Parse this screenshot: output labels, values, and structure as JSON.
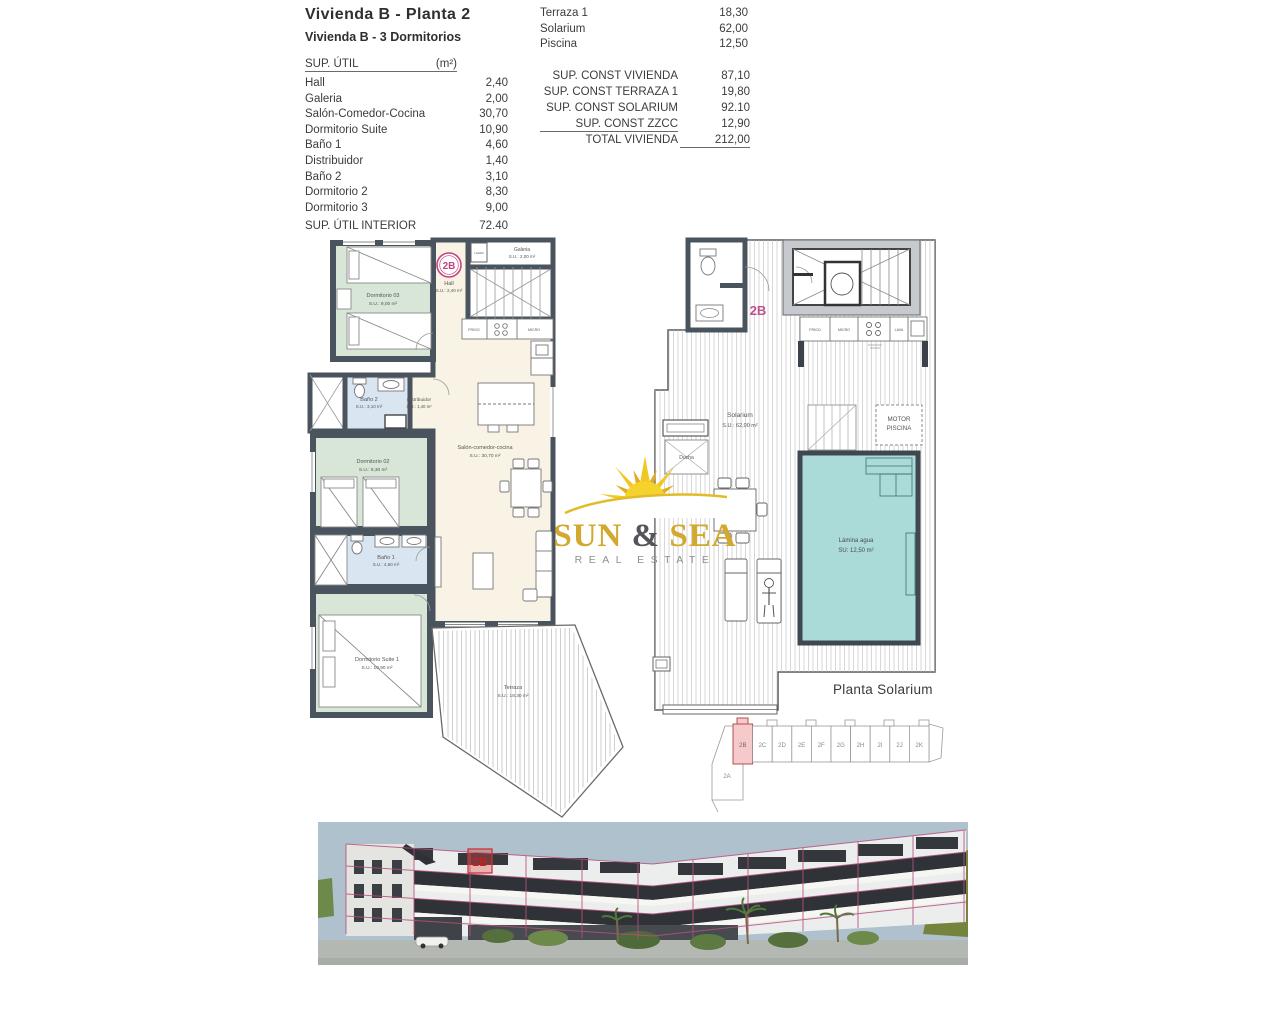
{
  "header": {
    "title": "Vivienda B - Planta 2",
    "subtitle": "Vivienda B - 3 Dormitorios"
  },
  "sup_util": {
    "label": "SUP. ÚTIL",
    "unit": "(m²)",
    "rows": [
      {
        "label": "Hall",
        "value": "2,40"
      },
      {
        "label": "Galeria",
        "value": "2,00"
      },
      {
        "label": "Salón-Comedor-Cocina",
        "value": "30,70"
      },
      {
        "label": "Dormitorio Suite",
        "value": "10,90"
      },
      {
        "label": "Baño 1",
        "value": "4,60"
      },
      {
        "label": "Distribuidor",
        "value": "1,40"
      },
      {
        "label": "Baño 2",
        "value": "3,10"
      },
      {
        "label": "Dormitorio 2",
        "value": "8,30"
      },
      {
        "label": "Dormitorio 3",
        "value": "9,00"
      }
    ],
    "total_label": "SUP. ÚTIL INTERIOR",
    "total_value": "72.40"
  },
  "exterior": {
    "rows": [
      {
        "label": "Terraza 1",
        "value": "18,30"
      },
      {
        "label": "Solarium",
        "value": "62,00"
      },
      {
        "label": "Piscina",
        "value": "12,50"
      }
    ]
  },
  "construida": {
    "rows": [
      {
        "label": "SUP. CONST VIVIENDA",
        "value": "87,10"
      },
      {
        "label": "SUP. CONST TERRAZA 1",
        "value": "19,80"
      },
      {
        "label": "SUP. CONST SOLARIUM",
        "value": "92.10"
      },
      {
        "label": "SUP. CONST ZZCC",
        "value": "12,90"
      }
    ],
    "total_label": "TOTAL VIVIENDA",
    "total_value": "212,00"
  },
  "plan": {
    "badge": "2B",
    "rooms": {
      "dorm3": {
        "name": "Dormitorio 03",
        "area": "S.U.: 9,00 m²"
      },
      "hall": {
        "name": "Hall",
        "area": "S.U.: 2,40 m²"
      },
      "galeria": {
        "name": "Galeria",
        "area": "S.U.: 2,00 m²"
      },
      "bano2": {
        "name": "Baño 2",
        "area": "S.U.: 3,10 m²"
      },
      "distrib": {
        "name": "Distribuidor",
        "area": "S.U.: 1,40 m²"
      },
      "salon": {
        "name": "Salón-comedor-cocina",
        "area": "S.U.: 30,70 m²"
      },
      "dorm2": {
        "name": "Dormitorio 02",
        "area": "S.U.: 8,30 m²"
      },
      "bano1": {
        "name": "Baño 1",
        "area": "S.U.: 4,60 m²"
      },
      "suite": {
        "name": "Dormitorio Suite 1",
        "area": "S.U.: 10,90 m²"
      },
      "terraza": {
        "name": "Terraza",
        "area": "S.U.: 18,30 m²"
      }
    },
    "appliances": {
      "frigo": "FRIGO",
      "micro": "MICRO",
      "lavad": "LAVAD"
    }
  },
  "solarium": {
    "unit": "2B",
    "room": {
      "name": "Solarium",
      "area": "S.U.: 62,00 m²"
    },
    "ducha": "Ducha",
    "motor": {
      "line1": "MOTOR",
      "line2": "PISCINA"
    },
    "pool": {
      "line1": "Lámina agua",
      "line2": "SU:  12,50 m²"
    },
    "kitchen": {
      "frigo": "FRIGO",
      "micro": "MICRO",
      "lava": "LAVA"
    },
    "caption": "Planta Solarium"
  },
  "locator": {
    "units": [
      "2B",
      "2C",
      "2D",
      "2E",
      "2F",
      "2G",
      "2H",
      "2I",
      "2J",
      "2K"
    ],
    "below_unit": "2A"
  },
  "render": {
    "unit_label": "2B"
  },
  "logo": {
    "word1": "SUN",
    "amp": "&",
    "word2": "SEA",
    "tagline": "REAL ESTATE"
  },
  "colors": {
    "wall": "#4a545e",
    "room_green": "#d7e6d6",
    "room_blue": "#dae5f2",
    "room_cream": "#f8f3e5",
    "pool": "#aadbd9",
    "accent_pink": "#c2457f",
    "logo_gold": "#d2a92e",
    "render_grid_pink": "#b84f7e",
    "render_sky": "#aec1cd"
  }
}
